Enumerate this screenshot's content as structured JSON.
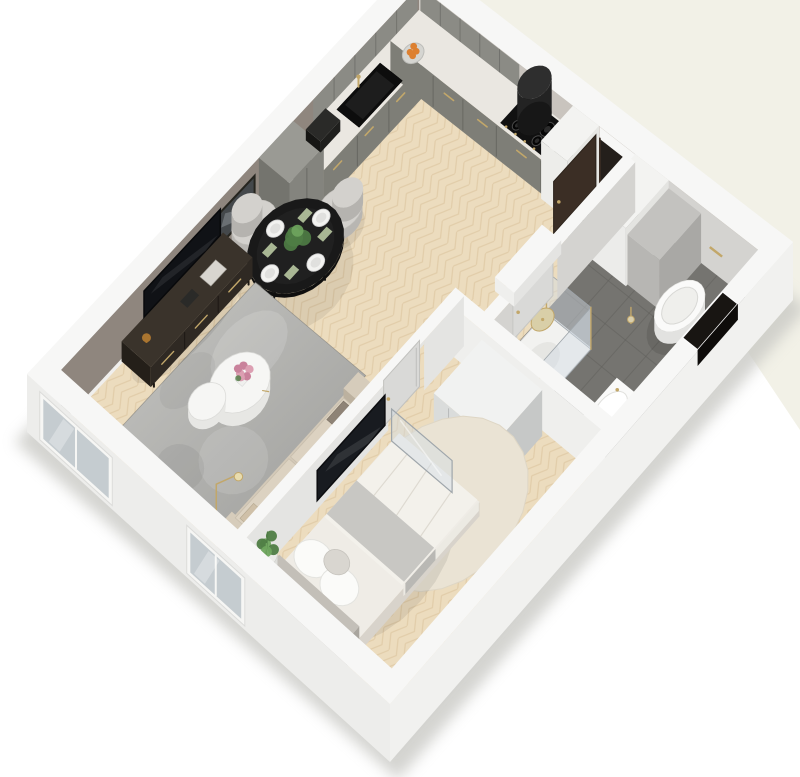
{
  "entry": {
    "doormat_text": "WELCOME"
  },
  "palette": {
    "background_tint": "#e8e6d3",
    "ground_shadow": "#c9c9c5",
    "wood_floor": "#ecdcbe",
    "wood_line": "#ddc7a1",
    "wall_cap": "#f7f7f6",
    "wall_ext": "#ededeb",
    "wall_ext_se": "#f1f1ef",
    "wall_int_greige": "#8f867e",
    "baseboard": "#f0efed",
    "wall_face_u": "#e4e4e2",
    "wall_face_v": "#efefed",
    "tile_wall": "#d4d3d0",
    "tile_floor": "#757470",
    "tile_line": "#62615d",
    "marble": "#eae7e1",
    "counter_front": "#7e7e77",
    "counter_side": "#6d6d66",
    "cabinet_gray": "#8b8b85",
    "cooktop_black": "#111111",
    "hood_black": "#232323",
    "hood_top": "#2e2e2e",
    "gold": "#c2a76a",
    "doorway_dark": "#241f1b",
    "door_brown": "#3b2e25",
    "door_leaf": "#d9d9d7",
    "mat": "#8e8e8b",
    "mat_text": "#30302e",
    "white_unit": "#f3f3f1",
    "gray_unit": "#b7b6b3",
    "table_black": "#191919",
    "chair_gray": "#d3d1cd",
    "chair_side": "#b8b6b2",
    "napkin_green": "#a9b794",
    "rug_gray": "#9d9d9a",
    "rug_light": "#c6c6c3",
    "sofa": "#d3c9b8",
    "sofa_dark": "#b7ac99",
    "cushion": "#dcd2c1",
    "pillow_taupe": "#8e8376",
    "coffee_white": "#f6f6f4",
    "flower_pink": "#dc9fb2",
    "flower_deep": "#c9829b",
    "tv_dark": "#101216",
    "stand_brown": "#2f2923",
    "stand_top": "#3a332b",
    "art_gray": "#44484b",
    "bed_white": "#f3f1eb",
    "blanket_gray": "#c8c7c3",
    "headboard": "#aba79f",
    "bed_side": "#d8d3cb",
    "round_rug": "#eae3d4",
    "wardrobe": "#dadcdb",
    "wardrobe_top": "#f1f2f1",
    "wardrobe_side": "#c6c8c7",
    "plant_green": "#4f7d45",
    "plant_light": "#6fa55e",
    "pot_white": "#ebebe8",
    "porcelain": "#fafaf9",
    "porcelain_side": "#e2e2e0",
    "glass": "rgba(210,220,228,0.45)",
    "glass_stroke": "#9fa6ab",
    "window_glass": "#c5ccd0",
    "orange_fruit": "#dd8030"
  }
}
